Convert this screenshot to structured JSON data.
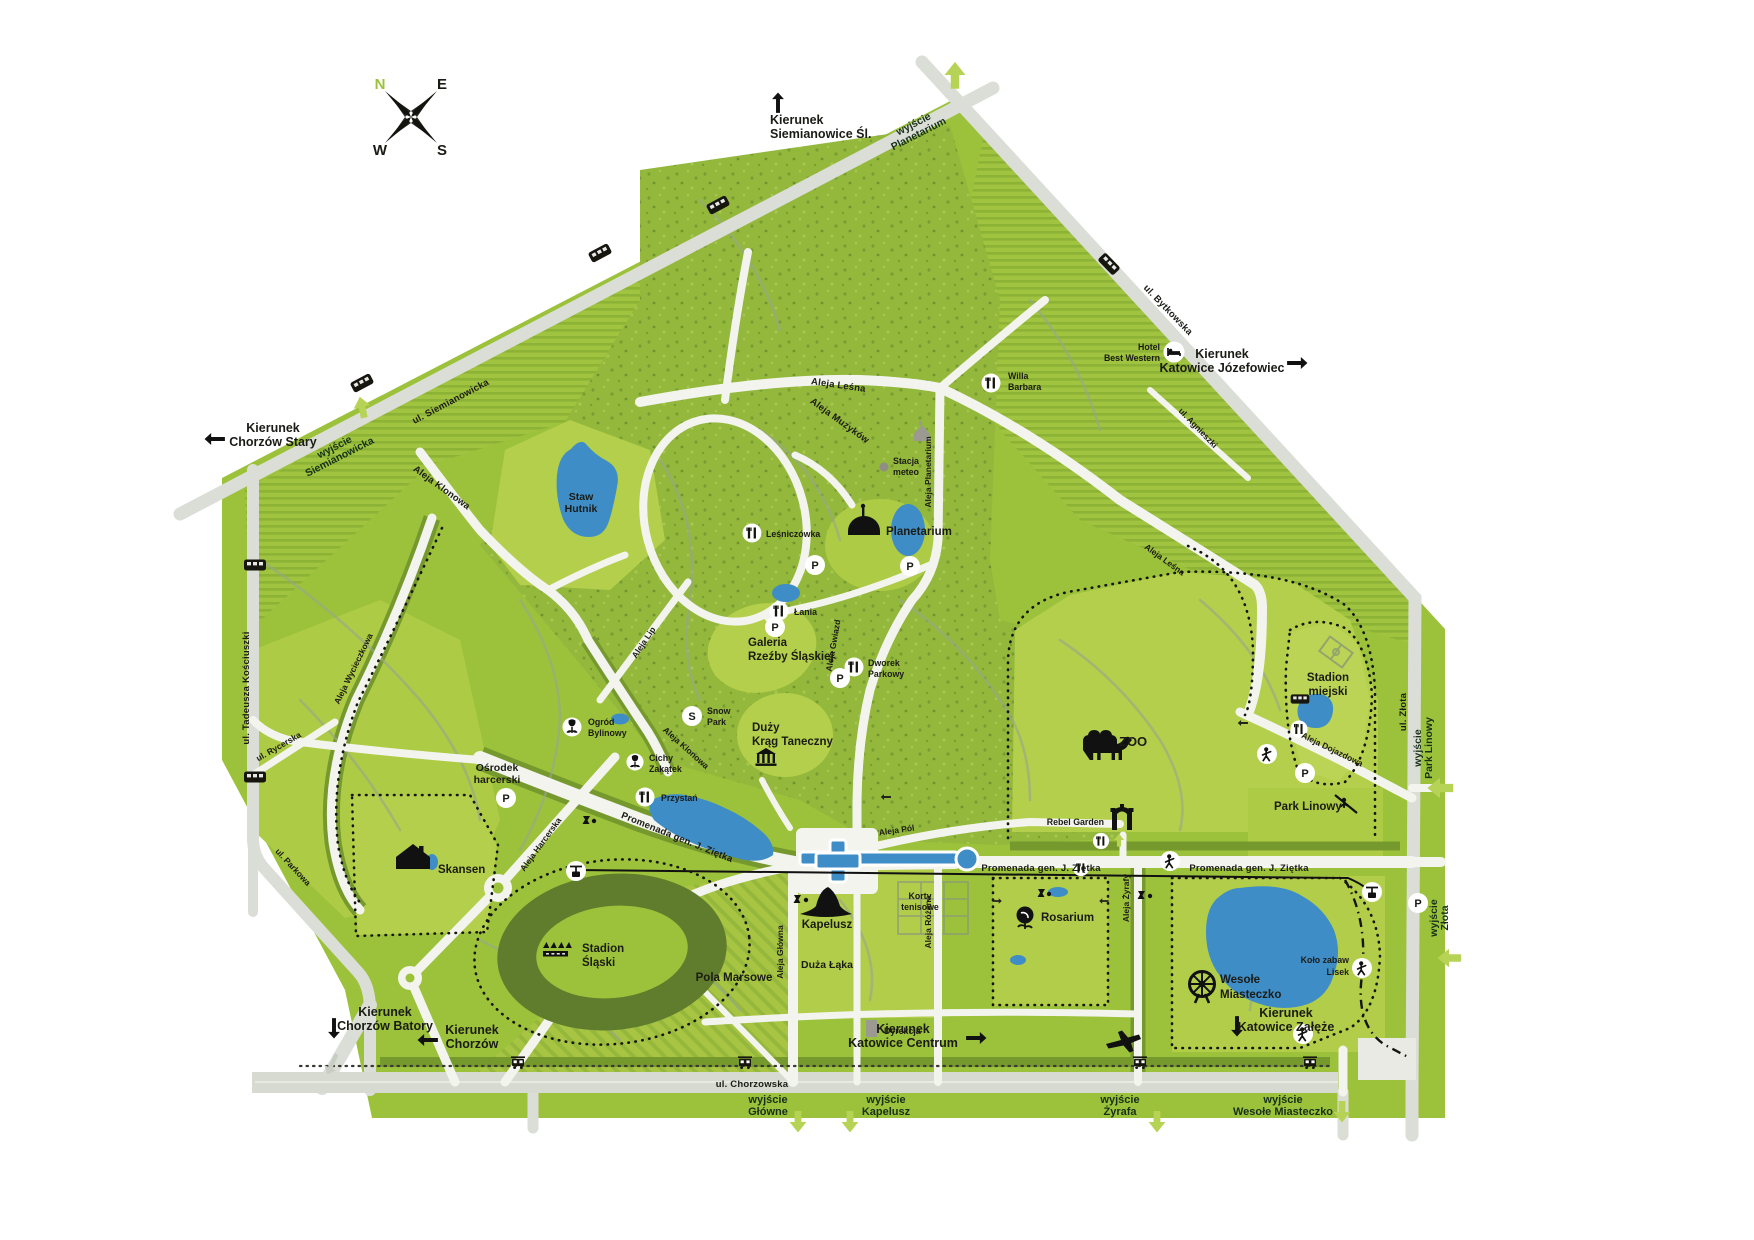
{
  "compass": {
    "n": "N",
    "e": "E",
    "s": "S",
    "w": "W"
  },
  "directions": {
    "siemianowice_1": "Kierunek",
    "siemianowice_2": "Siemianowice Śl.",
    "chorzow_stary_1": "Kierunek",
    "chorzow_stary_2": "Chorzów Stary",
    "jozefowiec_1": "Kierunek",
    "jozefowiec_2": "Katowice Józefowiec",
    "batory_1": "Kierunek",
    "batory_2": "Chorzów Batory",
    "chorzow_1": "Kierunek",
    "chorzow_2": "Chorzów",
    "centrum_1": "Kierunek",
    "centrum_2": "Katowice Centrum",
    "zaleze_1": "Kierunek",
    "zaleze_2": "Katowice Załęże"
  },
  "exits": {
    "planetarium_1": "wyjście",
    "planetarium_2": "Planetarium",
    "siemianowicka_1": "wyjście",
    "siemianowicka_2": "Siemianowicka",
    "park_linowy_1": "wyjście",
    "park_linowy_2": "Park Linowy",
    "zlota_1": "wyjście",
    "zlota_2": "Złota",
    "glowne_1": "wyjście",
    "glowne_2": "Główne",
    "kapelusz_1": "wyjście",
    "kapelusz_2": "Kapelusz",
    "zyrafa_1": "wyjście",
    "zyrafa_2": "Żyrafa",
    "wesole_1": "wyjście",
    "wesole_2": "Wesołe Miasteczko"
  },
  "streets": {
    "siemianowicka": "ul. Siemianowicka",
    "bytkowska": "ul. Bytkowska",
    "agnieszki": "ul. Agnieszki",
    "zlota": "ul. Złota",
    "kosciuszki": "ul. Tadeusza Kościuszki",
    "rycerska": "ul. Rycerska",
    "parkowa": "ul. Parkowa",
    "chorzowska": "ul. Chorzowska",
    "wycieczkowa": "Aleja Wycieczkowa",
    "klonowa": "Aleja Klonowa",
    "lesna": "Aleja Leśna",
    "muzykow": "Aleja Muzyków",
    "al_planetarium": "Aleja Planetarium",
    "gwiazd": "Aleja Gwiazd",
    "lip": "Aleja Lip",
    "harcerska": "Aleja Harcerska",
    "glowna": "Aleja Główna",
    "rozana": "Aleja Różana",
    "zyrafy": "Aleja Żyrafy",
    "dojazdowa": "Aleja Dojazdowa",
    "pol": "Aleja Pól",
    "promenada": "Promenada gen. J. Ziętka"
  },
  "pois": {
    "staw_hutnik_1": "Staw",
    "staw_hutnik_2": "Hutnik",
    "planetarium": "Planetarium",
    "stacja_meteo_1": "Stacja",
    "stacja_meteo_2": "meteo",
    "lesniczowka": "Leśniczówka",
    "lania": "Łania",
    "galeria_1": "Galeria",
    "galeria_2": "Rzeźby Śląskiej",
    "dworek_1": "Dworek",
    "dworek_2": "Parkowy",
    "duzy_krag_1": "Duży",
    "duzy_krag_2": "Krąg Taneczny",
    "snow_1": "Snow",
    "snow_2": "Park",
    "ogrod_1": "Ogród",
    "ogrod_2": "Bylinowy",
    "cichy_1": "Cichy",
    "cichy_2": "Zakątek",
    "przystan": "Przystań",
    "osrodek_1": "Ośrodek",
    "osrodek_2": "harcerski",
    "skansen": "Skansen",
    "stadion_slaski_1": "Stadion",
    "stadion_slaski_2": "Śląski",
    "pola_marsowe": "Pola Marsowe",
    "kapelusz": "Kapelusz",
    "duza_laka": "Duża Łąka",
    "dyrekcja": "Dyrekcja",
    "korty_1": "Korty",
    "korty_2": "tenisowe",
    "rosarium": "Rosarium",
    "zoo": "ZOO",
    "rebel_garden": "Rebel Garden",
    "hotel_1": "Hotel",
    "hotel_2": "Best Western",
    "willa_1": "Willa",
    "willa_2": "Barbara",
    "stadion_miejski_1": "Stadion",
    "stadion_miejski_2": "miejski",
    "park_linowy": "Park Linowy",
    "wesole_1": "Wesołe",
    "wesole_2": "Miasteczko",
    "kolo_zabaw_1": "Koło zabaw",
    "kolo_zabaw_2": "Lisek"
  },
  "markers": {
    "parking": "P",
    "snowpark": "S"
  },
  "colors": {
    "park_green": "#9cc23b",
    "meadow": "#b4cf4b",
    "water": "#3e8dc6",
    "road": "#f3f4ee",
    "accent": "#b7d355"
  }
}
